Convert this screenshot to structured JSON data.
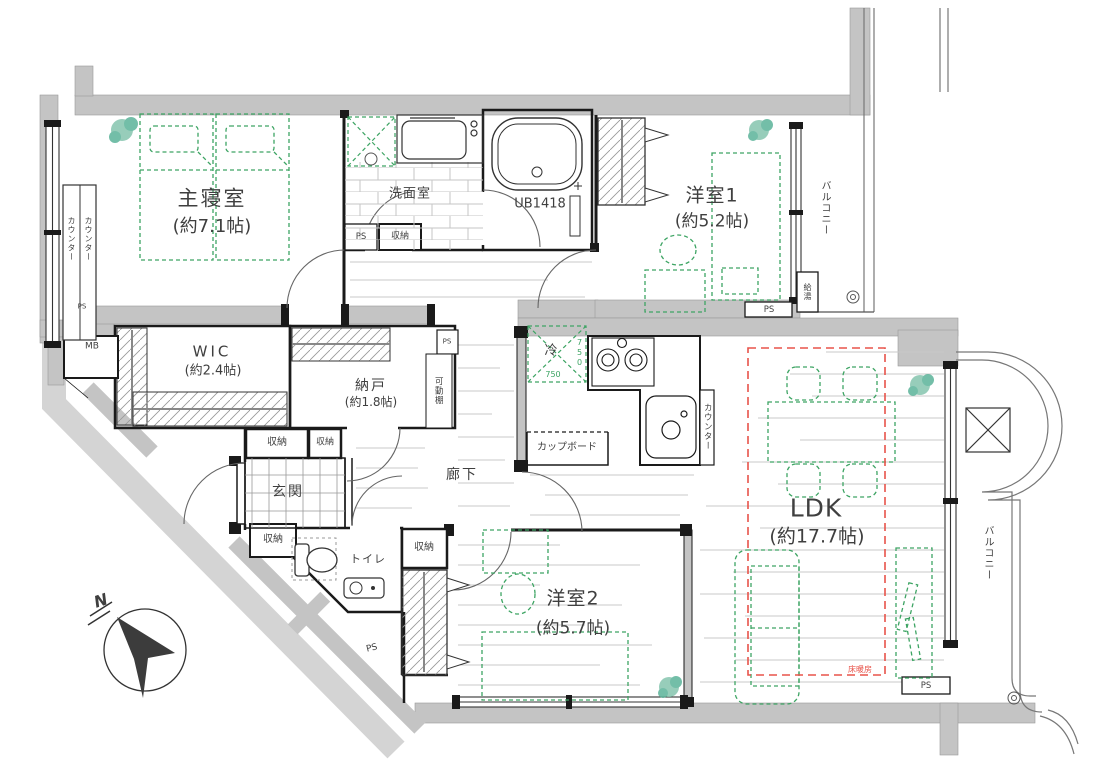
{
  "colors": {
    "wall_gray": "#c4c4c4",
    "outer_walkway_gray": "#d4d4d4",
    "line_black": "#1a1a1a",
    "furniture_green": "#3da463",
    "floor_heating_red": "#e8534a",
    "plant_teal": "#85c5ae",
    "floor_line_gray": "#c9c9c9"
  },
  "rooms": {
    "master": {
      "name": "主寝室",
      "size": "(約7.1帖)"
    },
    "youshitsu1": {
      "name": "洋室1",
      "size": "(約5.2帖)"
    },
    "youshitsu2": {
      "name": "洋室2",
      "size": "(約5.7帖)"
    },
    "ldk": {
      "name": "LDK",
      "size": "(約17.7帖)"
    },
    "wic": {
      "name": "WIC",
      "size": "(約2.4帖)"
    },
    "nando": {
      "name": "納戸",
      "size": "(約1.8帖)"
    },
    "washroom": {
      "name": "洗面室"
    },
    "bath": {
      "name": "UB1418"
    },
    "entrance": {
      "name": "玄関"
    },
    "corridor": {
      "name": "廊下"
    },
    "toilet": {
      "name": "トイレ"
    }
  },
  "labels": {
    "balcony_top": "バルコニー",
    "balcony_right": "バルコニー",
    "counter_master_a": "カウンター",
    "counter_master_b": "カウンター",
    "counter_kitchen": "カウンター",
    "cupboard": "カップボード",
    "fridge": "冷",
    "fridge_w": "750",
    "fridge_d": "750",
    "movable_shelf": "可動棚",
    "water_heater": "給湯",
    "floor_heating": "床暖房",
    "meter_box": "MB",
    "north": "N"
  },
  "storage_labels": [
    "収納",
    "収納",
    "収納",
    "収納",
    "収納"
  ],
  "ps_labels": [
    "PS",
    "PS",
    "PS",
    "PS",
    "PS",
    "PS"
  ]
}
